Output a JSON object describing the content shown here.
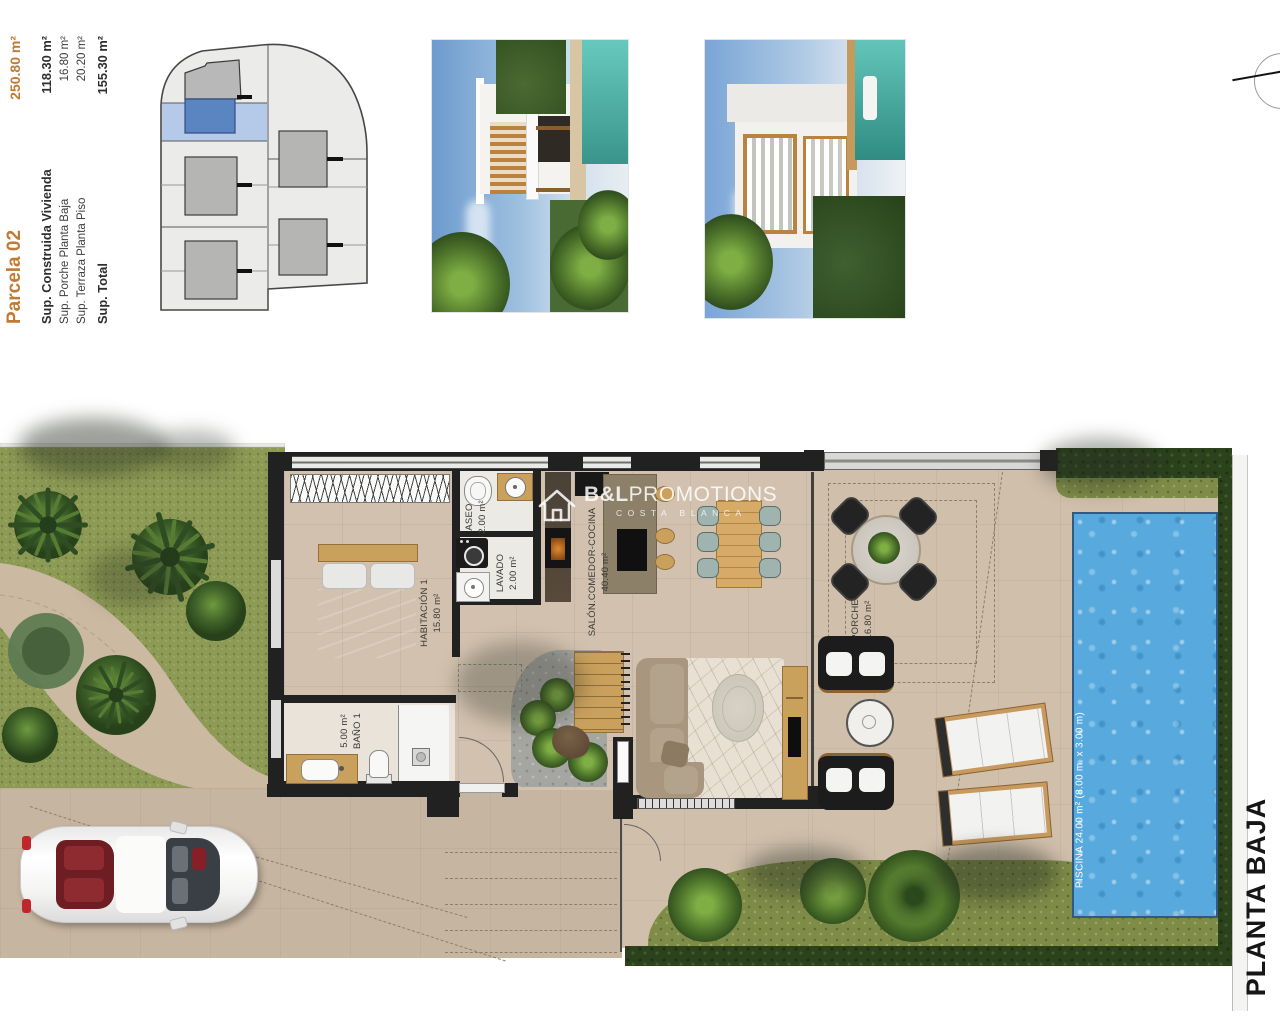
{
  "title_block": {
    "parcela": {
      "label": "Parcela 02",
      "area": "250.80 m²"
    },
    "specs": [
      {
        "label": "Sup. Construida Vivienda",
        "value": "118.30 m²"
      },
      {
        "label": "Sup. Porche Planta Baja",
        "value": "16.80 m²"
      },
      {
        "label": "Sup. Terraza Planta Piso",
        "value": "20.20 m²"
      },
      {
        "label": "Sup. Total",
        "value": "155.30 m²"
      }
    ]
  },
  "watermark": {
    "brand_bold": "B&L",
    "brand_regular": "PROMOTIONS",
    "subtitle": "COSTA BLANCA"
  },
  "plan": {
    "floor_label": "PLANTA BAJA",
    "rooms": {
      "habitacion1": {
        "name": "HABITACIÓN 1",
        "area": "15.80 m²"
      },
      "aseo": {
        "name": "ASEO",
        "area": "2.00 m²"
      },
      "lavado": {
        "name": "LAVADO",
        "area": "2.00 m²"
      },
      "salon": {
        "name": "SALÓN.COMEDOR-COCINA",
        "area": "40.40 m²"
      },
      "bano1": {
        "name": "BAÑO 1",
        "area": "5.00 m²"
      },
      "porche": {
        "name": "PORCHE",
        "area": "16.80 m²"
      },
      "piscina": {
        "label": "PISCINA 24.00 m² (8.00 m. x 3.00 m)"
      }
    }
  },
  "colors": {
    "accent_orange": "#c07a33",
    "highlight_blue": "#5b85c0",
    "pool_blue": "#58aade",
    "wall_dark": "#212121",
    "grass_green": "#87944c",
    "hedge_green": "#2b421d",
    "floor_beige": "#d2c1ae"
  }
}
